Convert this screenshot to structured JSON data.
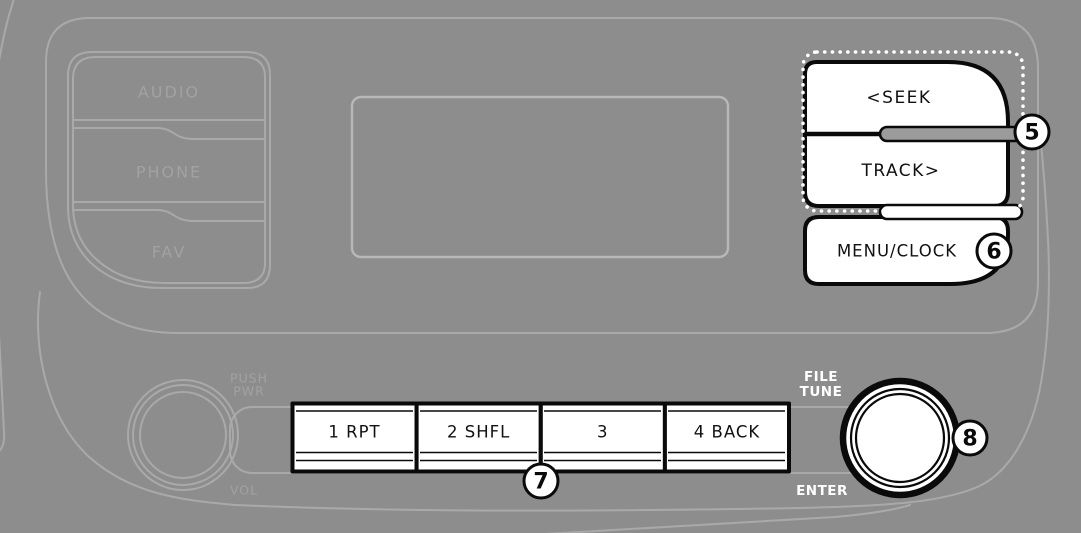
{
  "radio_panel": {
    "mode_buttons": [
      "AUDIO",
      "PHONE",
      "FAV"
    ],
    "power_volume_knob": {
      "push_label": "PUSH",
      "pwr_label": "PWR",
      "vol_label": "VOL"
    },
    "seek_button_label": "<SEEK",
    "track_button_label": "TRACK>",
    "menu_clock_button_label": "MENU/CLOCK",
    "preset_buttons": [
      "1 RPT",
      "2 SHFL",
      "3",
      "4 BACK"
    ],
    "file_tune_knob": {
      "file_label": "FILE",
      "tune_label": "TUNE",
      "enter_label": "ENTER"
    },
    "callouts": {
      "seek_track": "5",
      "menu_clock": "6",
      "preset_buttons": "7",
      "file_tune_knob": "8"
    },
    "colors": {
      "background": "#8d8d8d",
      "faint_outline": "#a9a9a9",
      "highlight_fill": "#ffffff",
      "highlight_stroke": "#0a0a0a",
      "muted_label": "#a2a2a2"
    }
  }
}
